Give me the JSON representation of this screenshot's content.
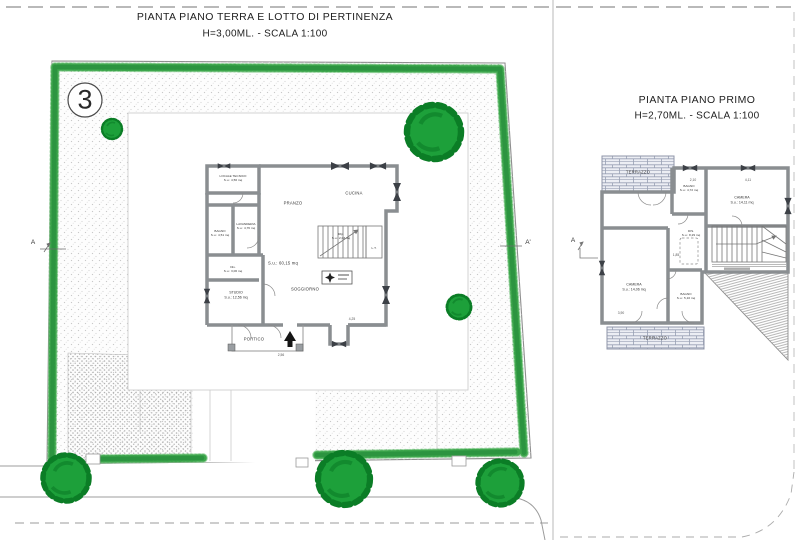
{
  "left_sheet": {
    "title": "PIANTA PIANO TERRA E LOTTO DI PERTINENZA",
    "subtitle": "H=3,00ML.  -  SCALA 1:100",
    "lot_number": "3",
    "section_left": "A",
    "section_right": "A'",
    "overall_area": "S.u.: 60,15 mq",
    "rooms": {
      "locale_tecnico": {
        "name": "LOCALE TECNICO",
        "area": "S.u.: 4,56 mq"
      },
      "lavanderia": {
        "name": "LAVANDERIA",
        "area": "S.u.: 4,76 mq"
      },
      "bagno": {
        "name": "BAGNO",
        "area": "S.u.: 4,51 mq"
      },
      "dis": {
        "name": "Dis.",
        "area": "S.u.: 3,06 mq"
      },
      "pranzo": {
        "name": "PRANZO"
      },
      "cucina": {
        "name": "CUCINA"
      },
      "studio": {
        "name": "STUDIO",
        "area": "S.u.: 12,56 mq"
      },
      "soggiorno": {
        "name": "SOGGIORNO"
      },
      "rip": {
        "name": "Rip.",
        "area": "S.u.: 2,03 mq"
      },
      "lt": {
        "name": "L.T."
      },
      "portico": {
        "name": "PORTICO"
      }
    },
    "dimensions": {
      "soggiorno_width": "4,25",
      "portico_width": "2,56"
    }
  },
  "right_sheet": {
    "title": "PIANTA PIANO PRIMO",
    "subtitle": "H=2,70ML.  -  SCALA 1:100",
    "section": "A",
    "rooms": {
      "terrazzo_top": {
        "name": "TERRAZZO"
      },
      "bagno_1": {
        "name": "BAGNO",
        "area": "S.u.: 4,72 mq"
      },
      "camera_right": {
        "name": "CAMERA",
        "area": "S.u.: 14,11 mq"
      },
      "camera_left": {
        "name": "CAMERA",
        "area": "S.u.: 14,06 mq"
      },
      "dis": {
        "name": "DIS.",
        "area": "S.u.: 8,29 mq"
      },
      "bagno_2": {
        "name": "BAGNO",
        "area": "S.u.: 5,10 mq"
      },
      "terrazzo_bottom": {
        "name": "TERRAZZO"
      }
    },
    "dimensions": {
      "bagno_width": "2,10",
      "camera_width": "4,11",
      "disimpegno": "1,85",
      "camera_left_width": "3,90"
    }
  },
  "colors": {
    "tree_green": "#1da03a",
    "hedge_green": "#3da64c",
    "wall_gray": "#8a8e91",
    "paper": "#ffffff"
  }
}
